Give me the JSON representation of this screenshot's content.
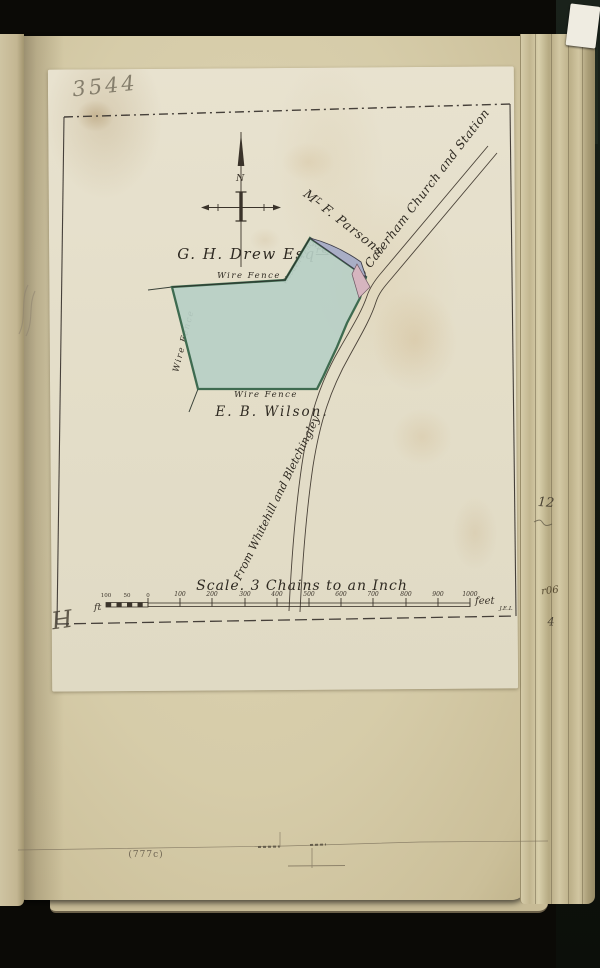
{
  "page": {
    "handwritten_number": "3544",
    "printed_reference": "(777c)",
    "corner_mark": "H",
    "surveyor_initials": "J.E.L",
    "edge_fragments": {
      "top": "12",
      "middle": "r06",
      "bottom": "4"
    }
  },
  "map": {
    "compass": {
      "north_label": "N"
    },
    "owners": {
      "drew_name": "G. H. Drew Esq",
      "drew_suffix": "re",
      "parsons_prefix": "M",
      "parsons_sup": "r",
      "parsons_name": " F. Parsons",
      "wilson_name": "E. B. Wilson."
    },
    "roads": {
      "to_label": "To Caterham Church and Station",
      "from_label": "From Whitehill and Bletchingley"
    },
    "fences": {
      "wire_top": "Wire Fence",
      "wire_left": "Wire Fence",
      "wire_bottom": "Wire Fence",
      "wooden_left": "Wooden Fence",
      "wooden_right": "Wooden Fence"
    },
    "scale": {
      "title": "Scale. 3 Chains to an Inch",
      "unit_prefix": "ft",
      "unit_suffix": "feet",
      "sub_ticks": [
        "100",
        "50",
        "0"
      ],
      "main_ticks": [
        "100",
        "200",
        "300",
        "400",
        "500",
        "600",
        "700",
        "800",
        "900",
        "1000"
      ]
    },
    "colors": {
      "plot_fill": "#b7cfc6",
      "plot_stroke": "#3e6b50",
      "wooden_fence_fill": "#a9aec6",
      "gate_parcel_fill": "#d6b5bf",
      "ink": "#3a332a"
    }
  }
}
